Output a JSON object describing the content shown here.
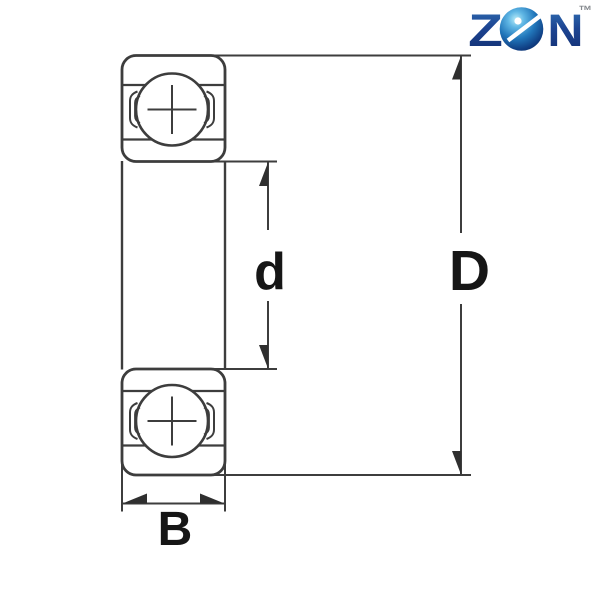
{
  "logo": {
    "letter_z": "Z",
    "letter_n": "N",
    "trademark": "™",
    "ball_icon": "bearing-ball-icon",
    "brand_blue": "#1b4190",
    "ball_blue": "#1d6db3",
    "ball_highlight": "#b8ecf8"
  },
  "diagram": {
    "line_color": "#3d3d3d",
    "label_color": "#161616",
    "labels": {
      "bore_diameter": "d",
      "outer_diameter": "D",
      "width": "B"
    }
  }
}
